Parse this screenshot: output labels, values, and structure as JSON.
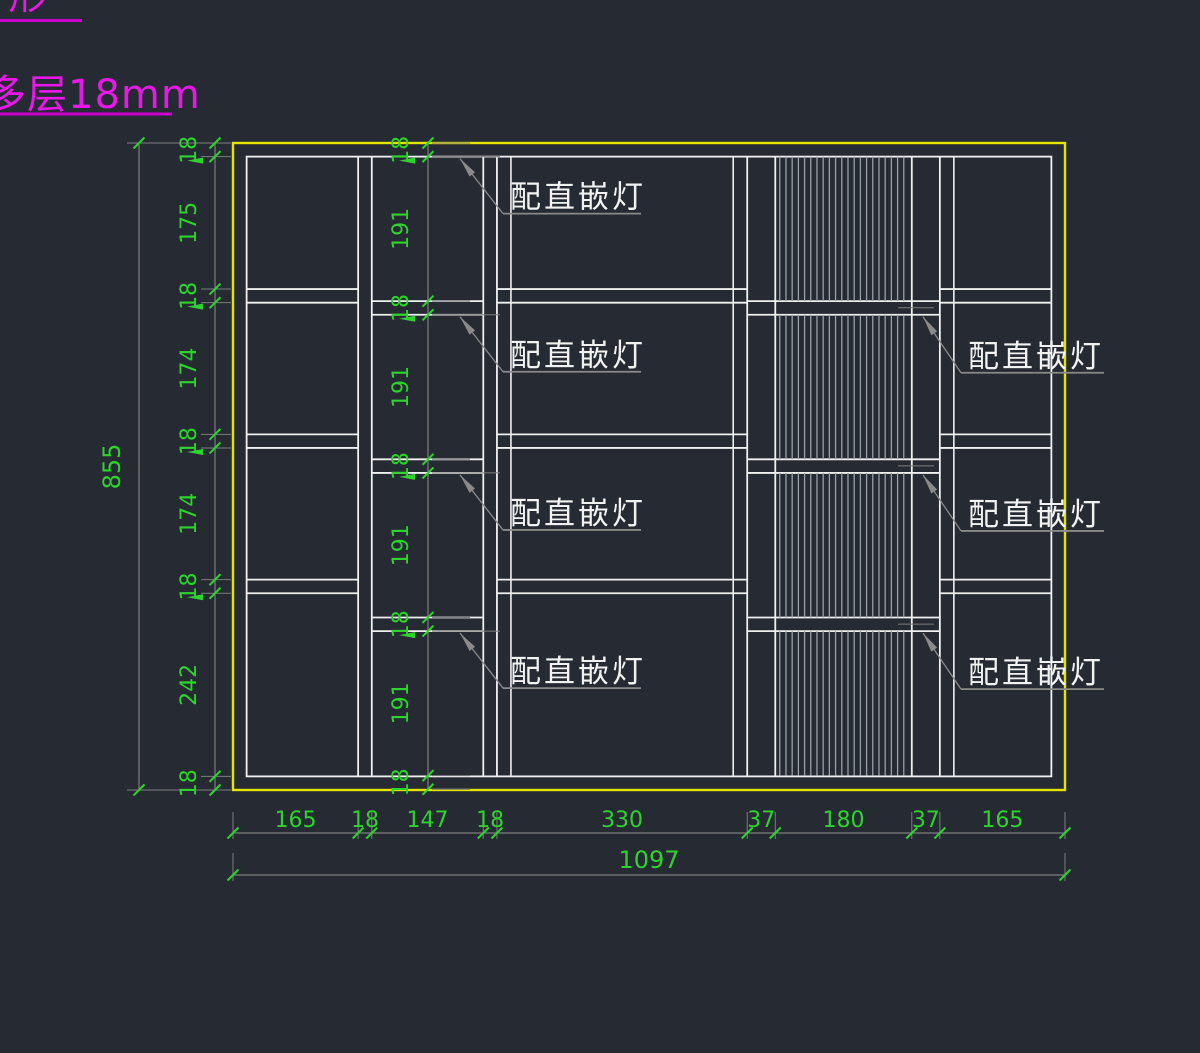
{
  "annotations": {
    "top_fragment": {
      "text": "形",
      "underline_px": 82
    },
    "material": {
      "text": "多层18mm",
      "underline_px": 172
    }
  },
  "cabinet": {
    "overall_width_label": "1097",
    "overall_height_label": "855",
    "columns_mm": [
      165,
      18,
      147,
      18,
      330,
      37,
      180,
      37,
      165
    ],
    "left_chain_mm": [
      18,
      175,
      18,
      174,
      18,
      174,
      18,
      242,
      18
    ],
    "inner_chain_mm": [
      18,
      191,
      18,
      191,
      18,
      191,
      18,
      191,
      18
    ]
  },
  "labels": {
    "light_label": "配直嵌灯",
    "middle_instances": 4,
    "right_instances": 3
  },
  "geometry": {
    "origin_x": 233,
    "origin_y": 143,
    "right_x": 1065,
    "bottom_y": 790,
    "dim_height_line_x": 139,
    "dim_height_text_x": 120,
    "left_chain_x": 215,
    "left_text_x": 196,
    "inner_chain_x": 428,
    "inner_text_x": 408,
    "bottom_chain_y": 833,
    "bottom_total_y": 875,
    "mid_leader_x": 460,
    "right_leader_x": 923
  },
  "colors": {
    "background": "#252a33",
    "outline_yellow": "#e4e400",
    "line_white": "#f0f0f0",
    "dim_green": "#2cd42c",
    "dim_gray": "#7d7d7d",
    "leader_gray": "#8a8a8a",
    "hatch_gray": "#99a0a8",
    "label_white": "#f2f2f2",
    "magenta": "#e818e8",
    "magenta_line": "#cc00cc"
  }
}
